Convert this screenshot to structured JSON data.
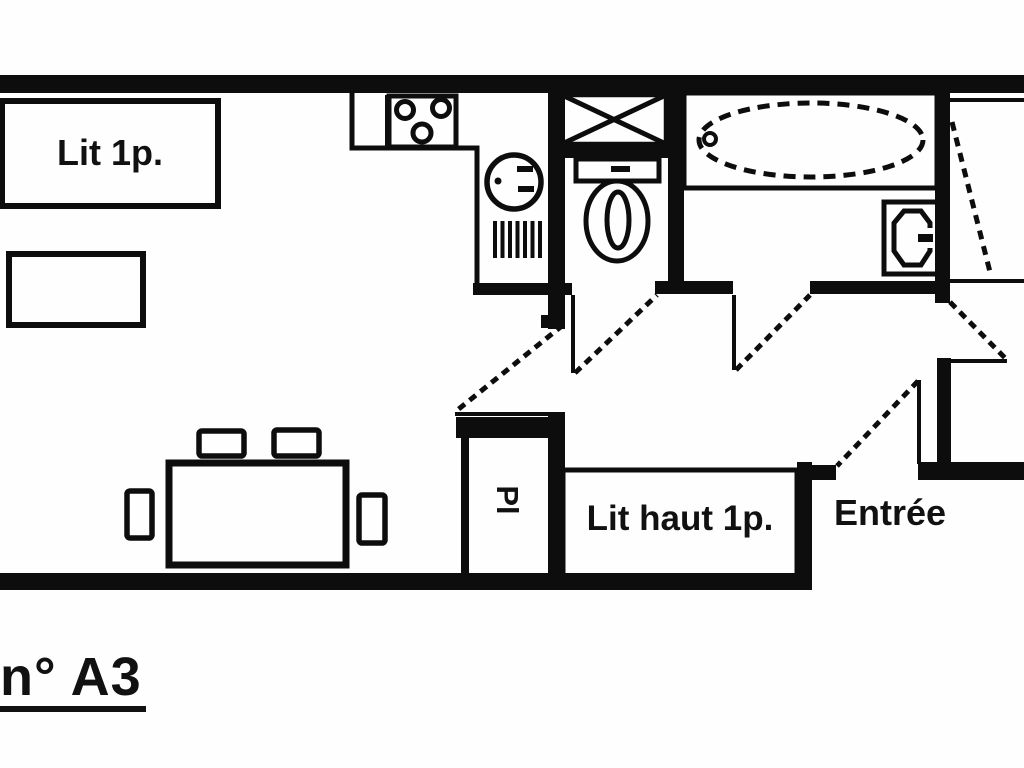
{
  "floorplan": {
    "unit_label": "n° A3",
    "labels": {
      "single_bed": "Lit 1p.",
      "closet": "Pl",
      "loft_bed": "Lit haut 1p.",
      "entrance": "Entrée"
    },
    "colors": {
      "ink": "#0d0d0d",
      "background": "#ffffff"
    },
    "fixtures": [
      "stove-icon",
      "kitchen-sink-icon",
      "drainboard-icon",
      "washing-machine-icon",
      "toilet-icon",
      "bathtub-icon",
      "washbasin-icon",
      "dining-table",
      "chair",
      "single-bed",
      "small-table",
      "loft-bed",
      "closet",
      "door-swing"
    ]
  }
}
